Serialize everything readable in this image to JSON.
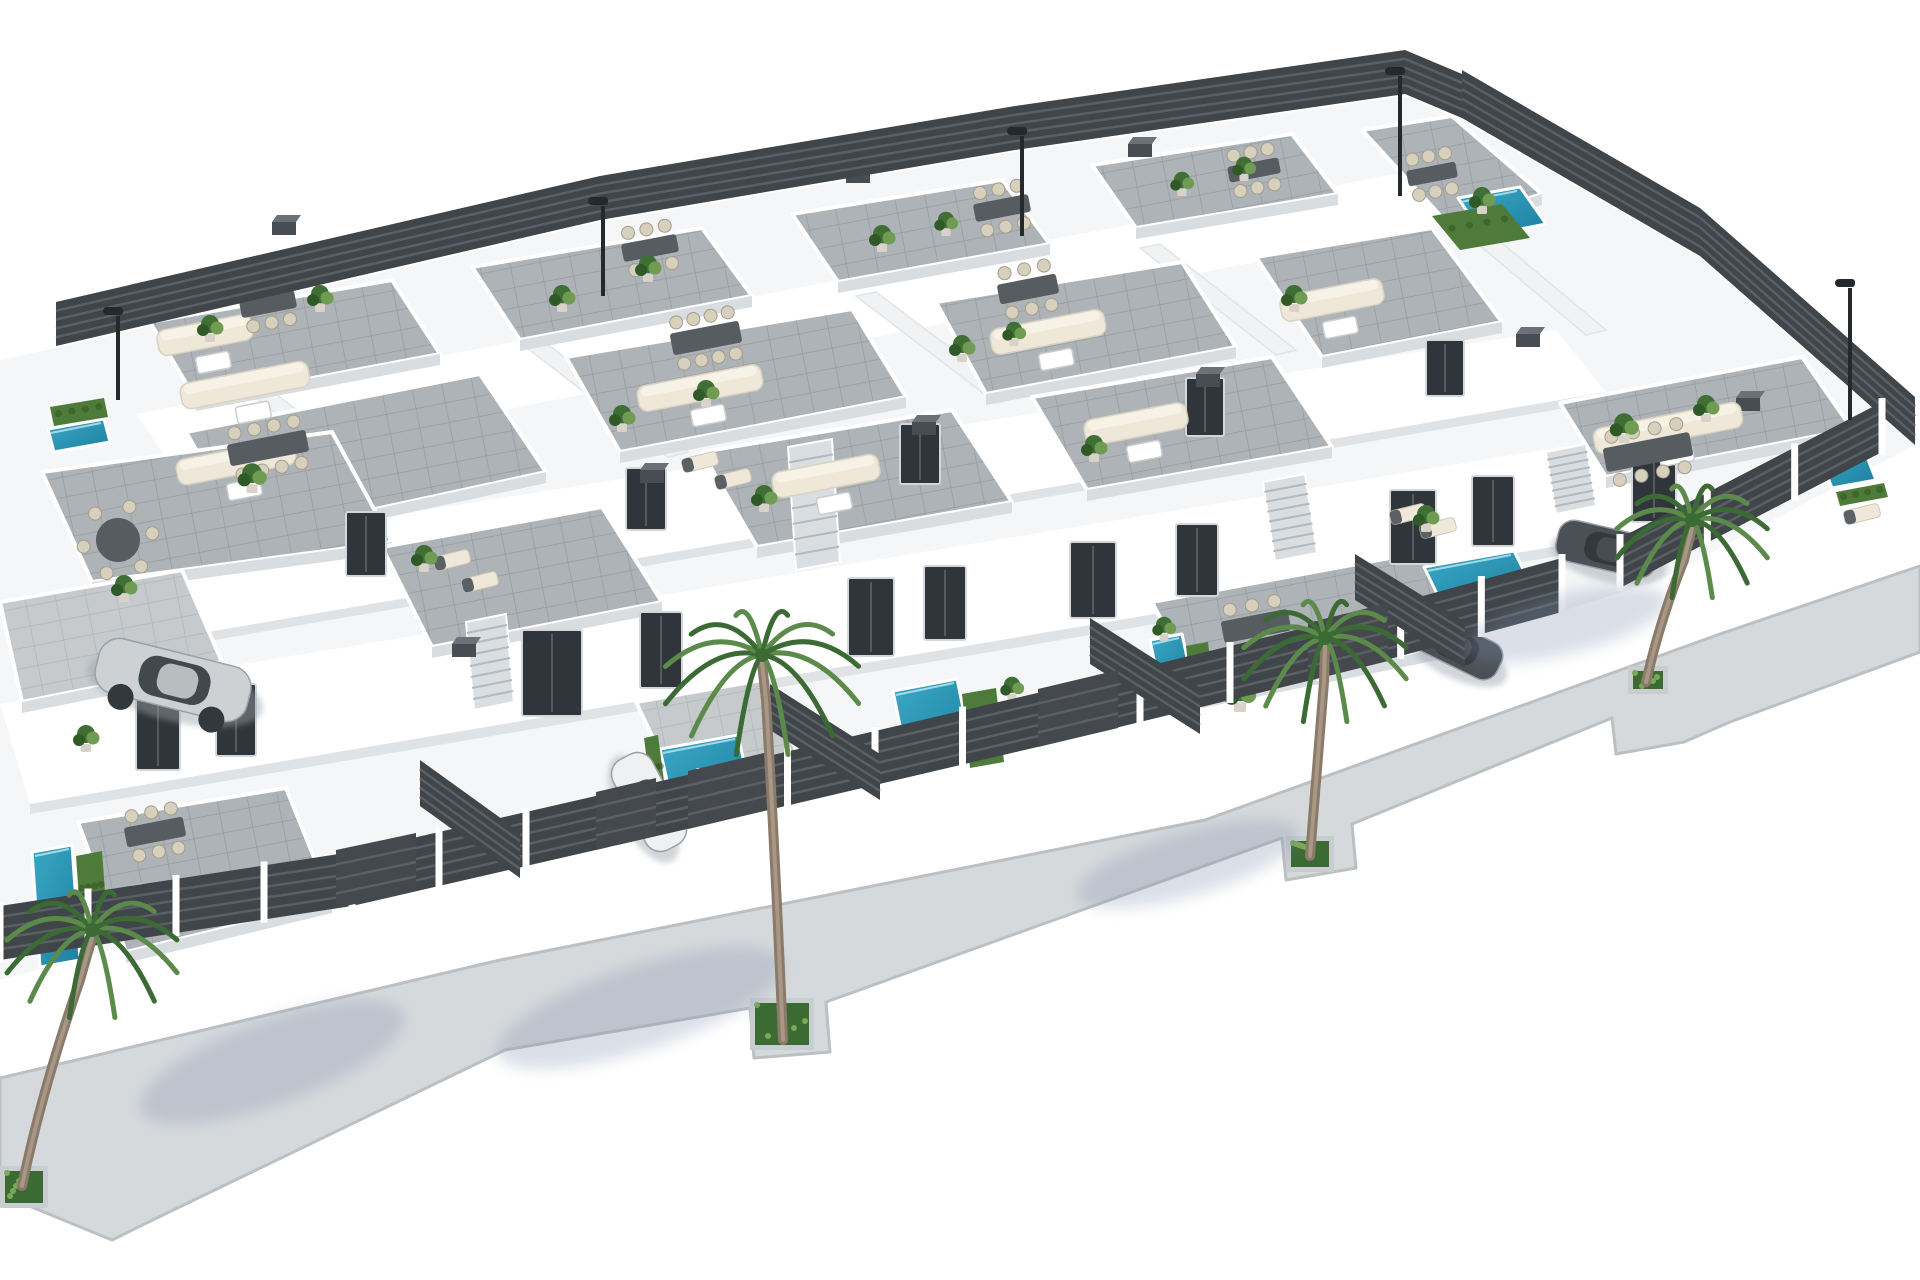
{
  "meta": {
    "description": "3D aerial architectural rendering of a modern white villa residential complex with grey-tiled rooftop terraces, outdoor lounge and dining furniture, private turquoise pools, dark slatted perimeter fences, palm trees on a surrounding sidewalk, parked cars and street lamps on a white background."
  },
  "scene": {
    "background": "#ffffff",
    "colors": {
      "wall": "#ffffff",
      "wall_shade": "#e8ebee",
      "terrace_tile": "#adb3b6",
      "terrace_tile_light": "#c6cacc",
      "terrace_grout": "#969ca0",
      "fence_dark": "#3f4549",
      "fence_slat": "#5a5f64",
      "pool_light": "#3aa8c6",
      "pool_deep": "#1d7fa0",
      "hedge_green": "#4e7b3a",
      "plant_green": "#3f6f35",
      "plant_light": "#6f9c52",
      "palm_green": "#5b8a4a",
      "palm_dark": "#3c6a35",
      "trunk_brown": "#8a7a6a",
      "sidewalk": "#d6d9db",
      "sidewalk_edge": "#bcc0c3",
      "shadow_blue": "#7e90ad",
      "car_silver": "#cdd1d4",
      "car_white": "#eef0f1",
      "car_dark": "#4a5056",
      "glass_dark": "#2f353a",
      "cream": "#efe8d8",
      "furniture_gray": "#565c60",
      "lamp_black": "#26292c"
    },
    "counts": {
      "villas_visible": 15,
      "rooftop_terraces": 18,
      "pools": 8,
      "palm_trees": 4,
      "street_lamps": 5,
      "cars": 4
    }
  },
  "ground": {
    "lot": [
      56,
      348,
      600,
      222,
      1015,
      152,
      1405,
      96,
      1462,
      120,
      1700,
      258,
      1915,
      445,
      1660,
      580,
      1560,
      612,
      1320,
      678,
      1050,
      742,
      700,
      814,
      352,
      884,
      0,
      980,
      0,
      360
    ],
    "sidewalk": [
      0,
      1078,
      500,
      960,
      1205,
      820,
      1720,
      634,
      1920,
      566,
      1920,
      652,
      1730,
      722,
      1684,
      742,
      1616,
      754,
      1612,
      718,
      1352,
      824,
      1356,
      868,
      1286,
      880,
      1282,
      838,
      826,
      1002,
      830,
      1052,
      754,
      1058,
      750,
      1008,
      505,
      1050,
      165,
      1214,
      112,
      1240,
      0,
      1194
    ]
  },
  "objects": {
    "wallbands": [
      [
        136,
        414,
        1458,
        162,
        1500,
        214,
        178,
        474
      ],
      [
        100,
        562,
        1556,
        330,
        1606,
        392,
        150,
        642
      ],
      [
        0,
        704,
        1652,
        432,
        1688,
        524,
        30,
        804
      ]
    ],
    "wallshades": [
      [
        30,
        804,
        1688,
        524,
        1688,
        534,
        30,
        814
      ],
      [
        150,
        642,
        1606,
        392,
        1606,
        401,
        150,
        651
      ]
    ],
    "separators": [
      [
        248,
        392,
        268,
        388,
        418,
        502,
        398,
        507
      ],
      [
        522,
        344,
        542,
        340,
        688,
        452,
        668,
        457
      ],
      [
        856,
        296,
        876,
        292,
        1016,
        398,
        996,
        403
      ],
      [
        1140,
        248,
        1160,
        244,
        1296,
        350,
        1276,
        355
      ],
      [
        1452,
        222,
        1472,
        218,
        1606,
        330,
        1586,
        335
      ]
    ],
    "terraces": [
      {
        "p": [
          150,
          322,
          392,
          280,
          440,
          354,
          196,
          400
        ]
      },
      {
        "p": [
          472,
          267,
          702,
          228,
          752,
          296,
          520,
          340
        ]
      },
      {
        "p": [
          792,
          214,
          1002,
          180,
          1050,
          244,
          838,
          282
        ]
      },
      {
        "p": [
          1092,
          165,
          1292,
          134,
          1338,
          194,
          1136,
          228
        ]
      },
      {
        "p": [
          1362,
          130,
          1452,
          116,
          1542,
          194,
          1448,
          224
        ]
      },
      {
        "p": [
          186,
          432,
          480,
          374,
          546,
          472,
          246,
          537
        ]
      },
      {
        "p": [
          566,
          357,
          852,
          309,
          906,
          397,
          620,
          452
        ]
      },
      {
        "p": [
          936,
          302,
          1182,
          262,
          1236,
          347,
          986,
          394
        ]
      },
      {
        "p": [
          1256,
          257,
          1432,
          228,
          1502,
          322,
          1322,
          357
        ]
      },
      {
        "p": [
          1560,
          403,
          1802,
          357,
          1852,
          429,
          1606,
          477
        ]
      },
      {
        "p": [
          42,
          472,
          332,
          432,
          392,
          542,
          92,
          582
        ]
      },
      {
        "p": [
          382,
          547,
          602,
          507,
          662,
          602,
          432,
          647
        ]
      },
      {
        "p": [
          702,
          452,
          952,
          410,
          1012,
          502,
          757,
          547
        ]
      },
      {
        "p": [
          1032,
          397,
          1272,
          357,
          1332,
          447,
          1087,
          490
        ]
      },
      {
        "p": [
          0,
          602,
          182,
          570,
          222,
          662,
          22,
          702
        ],
        "t": 2
      },
      {
        "p": [
          1152,
          602,
          1422,
          552,
          1472,
          642,
          1202,
          697
        ]
      },
      {
        "p": [
          636,
          702,
          762,
          680,
          802,
          762,
          676,
          787
        ],
        "t": 2
      },
      {
        "p": [
          78,
          822,
          286,
          788,
          332,
          902,
          126,
          952
        ]
      }
    ],
    "stairs": [
      [
        788,
        447,
        832,
        439,
        840,
        562,
        796,
        570
      ],
      [
        1263,
        482,
        1305,
        474,
        1317,
        553,
        1275,
        561
      ],
      [
        466,
        622,
        506,
        614,
        514,
        702,
        474,
        710
      ],
      [
        1546,
        452,
        1586,
        444,
        1596,
        506,
        1556,
        514
      ]
    ],
    "pools": [
      [
        1458,
        198,
        1520,
        187,
        1546,
        224,
        1484,
        236
      ],
      [
        1818,
        452,
        1862,
        444,
        1876,
        480,
        1832,
        488
      ],
      [
        1424,
        567,
        1514,
        551,
        1534,
        591,
        1444,
        608
      ],
      [
        1150,
        640,
        1182,
        634,
        1192,
        681,
        1160,
        688
      ],
      [
        893,
        691,
        957,
        679,
        974,
        762,
        910,
        775
      ],
      [
        660,
        749,
        738,
        735,
        754,
        807,
        676,
        821
      ],
      [
        32,
        852,
        72,
        845,
        80,
        960,
        40,
        967
      ],
      [
        48,
        429,
        104,
        419,
        110,
        442,
        54,
        452
      ]
    ],
    "hedges": [
      [
        76,
        856,
        102,
        851,
        108,
        932,
        82,
        938
      ],
      [
        644,
        738,
        658,
        735,
        668,
        812,
        654,
        815
      ],
      [
        1426,
        612,
        1514,
        596,
        1519,
        611,
        1431,
        627
      ],
      [
        1836,
        492,
        1884,
        483,
        1888,
        497,
        1840,
        506
      ],
      [
        962,
        694,
        996,
        688,
        1004,
        762,
        970,
        768
      ],
      [
        50,
        407,
        104,
        398,
        108,
        417,
        54,
        426
      ],
      [
        1186,
        646,
        1208,
        642,
        1214,
        694,
        1192,
        698
      ],
      [
        1432,
        216,
        1502,
        204,
        1530,
        238,
        1460,
        250
      ]
    ],
    "doors": [
      [
        136,
        696,
        44,
        74
      ],
      [
        216,
        684,
        40,
        72
      ],
      [
        522,
        630,
        60,
        86
      ],
      [
        640,
        612,
        42,
        76
      ],
      [
        848,
        578,
        46,
        78
      ],
      [
        924,
        566,
        42,
        74
      ],
      [
        1070,
        542,
        46,
        76
      ],
      [
        1176,
        524,
        42,
        72
      ],
      [
        1390,
        490,
        46,
        74
      ],
      [
        1472,
        476,
        42,
        70
      ],
      [
        1632,
        450,
        44,
        72
      ],
      [
        346,
        512,
        40,
        64
      ],
      [
        626,
        468,
        40,
        62
      ],
      [
        900,
        424,
        40,
        60
      ],
      [
        1186,
        378,
        38,
        58
      ],
      [
        1426,
        340,
        38,
        56
      ]
    ],
    "acs": [
      [
        272,
        222
      ],
      [
        560,
        202
      ],
      [
        846,
        170
      ],
      [
        1128,
        144
      ],
      [
        640,
        470
      ],
      [
        912,
        422
      ],
      [
        1196,
        374
      ],
      [
        452,
        644
      ],
      [
        1516,
        334
      ],
      [
        1736,
        398
      ]
    ],
    "sofas": [
      [
        205,
        335,
        96
      ],
      [
        245,
        385,
        130
      ],
      [
        700,
        388,
        126
      ],
      [
        1048,
        332,
        116
      ],
      [
        1332,
        300,
        104
      ],
      [
        1668,
        428,
        150
      ],
      [
        826,
        476,
        108
      ],
      [
        1136,
        424,
        104
      ],
      [
        236,
        462,
        120
      ]
    ],
    "dinings": [
      {
        "x": 706,
        "y": 338,
        "w": 70,
        "h": 22,
        "n": 8
      },
      {
        "x": 1028,
        "y": 289,
        "w": 60,
        "h": 20,
        "n": 6
      },
      {
        "x": 1648,
        "y": 452,
        "w": 88,
        "h": 24,
        "n": 8
      },
      {
        "x": 1256,
        "y": 626,
        "w": 68,
        "h": 22,
        "n": 6
      },
      {
        "x": 268,
        "y": 448,
        "w": 80,
        "h": 22,
        "n": 8
      },
      {
        "x": 268,
        "y": 304,
        "w": 56,
        "h": 18,
        "n": 6
      },
      {
        "x": 650,
        "y": 248,
        "w": 56,
        "h": 18,
        "n": 6
      },
      {
        "x": 1002,
        "y": 208,
        "w": 56,
        "h": 18,
        "n": 6
      },
      {
        "x": 1254,
        "y": 170,
        "w": 52,
        "h": 16,
        "n": 6
      },
      {
        "x": 1432,
        "y": 174,
        "w": 50,
        "h": 16,
        "n": 6
      },
      {
        "x": 155,
        "y": 832,
        "w": 60,
        "h": 20,
        "n": 6
      },
      {
        "x": 118,
        "y": 540,
        "r": 22,
        "n": 6,
        "round": 1
      }
    ],
    "loungers": [
      [
        452,
        560
      ],
      [
        480,
        582
      ],
      [
        700,
        462
      ],
      [
        733,
        479
      ],
      [
        1408,
        514
      ],
      [
        1438,
        528
      ],
      [
        128,
        894
      ],
      [
        162,
        914
      ],
      [
        1862,
        514
      ]
    ],
    "plants": [
      [
        210,
        332,
        1
      ],
      [
        320,
        302,
        1
      ],
      [
        562,
        302,
        1
      ],
      [
        648,
        272,
        1
      ],
      [
        882,
        242,
        1
      ],
      [
        946,
        227,
        0.9
      ],
      [
        1182,
        187,
        0.9
      ],
      [
        1244,
        172,
        0.9
      ],
      [
        1482,
        204,
        1
      ],
      [
        252,
        482,
        1.1
      ],
      [
        622,
        422,
        1
      ],
      [
        706,
        397,
        1
      ],
      [
        962,
        352,
        1
      ],
      [
        1014,
        337,
        0.9
      ],
      [
        1294,
        302,
        1
      ],
      [
        1624,
        432,
        1.1
      ],
      [
        1706,
        412,
        1
      ],
      [
        124,
        592,
        1
      ],
      [
        424,
        562,
        1
      ],
      [
        764,
        502,
        1
      ],
      [
        1094,
        452,
        1
      ],
      [
        1426,
        522,
        1
      ],
      [
        234,
        692,
        1
      ],
      [
        1164,
        632,
        0.9
      ],
      [
        1012,
        692,
        0.9
      ],
      [
        1352,
        642,
        0.9
      ],
      [
        86,
        742,
        1
      ],
      [
        1240,
        700,
        1.2
      ]
    ],
    "fences": [
      [
        56,
        346,
        600,
        220,
        44,
        0
      ],
      [
        600,
        220,
        1015,
        150,
        44,
        0
      ],
      [
        1015,
        150,
        1405,
        94,
        44,
        0
      ],
      [
        1405,
        94,
        1462,
        118,
        44,
        0
      ],
      [
        1462,
        118,
        1700,
        256,
        48,
        0
      ],
      [
        1700,
        256,
        1915,
        445,
        48,
        0
      ],
      [
        0,
        960,
        352,
        906,
        54,
        1
      ],
      [
        352,
        906,
        700,
        826,
        54,
        1
      ],
      [
        700,
        826,
        1050,
        744,
        54,
        1
      ],
      [
        1050,
        744,
        1320,
        678,
        54,
        1
      ],
      [
        1320,
        678,
        1562,
        612,
        54,
        1
      ],
      [
        1620,
        588,
        1882,
        452,
        50,
        1
      ],
      [
        420,
        806,
        520,
        878,
        46,
        0
      ],
      [
        770,
        730,
        880,
        800,
        46,
        0
      ],
      [
        1090,
        664,
        1200,
        734,
        46,
        0
      ],
      [
        1355,
        600,
        1465,
        668,
        46,
        0
      ]
    ],
    "gates": [
      [
        336,
        908,
        416,
        891
      ],
      [
        688,
        829,
        768,
        810
      ],
      [
        1038,
        747,
        1118,
        728
      ],
      [
        1308,
        681,
        1388,
        661
      ],
      [
        596,
        850,
        656,
        836
      ]
    ],
    "cars": [
      {
        "x": 95,
        "y": 652,
        "rot": 14,
        "len": 156,
        "wid": 56,
        "body": "silver",
        "wheels": 1
      },
      {
        "x": 598,
        "y": 780,
        "rot": 62,
        "len": 102,
        "wid": 44,
        "body": "white",
        "wheels": 0
      },
      {
        "x": 1408,
        "y": 626,
        "rot": 26,
        "len": 96,
        "wid": 40,
        "body": "dark",
        "wheels": 0
      },
      {
        "x": 1556,
        "y": 528,
        "rot": 13,
        "len": 102,
        "wid": 42,
        "body": "dark",
        "wheels": 0
      }
    ],
    "planters": [
      [
        750,
        998,
        64,
        52
      ],
      [
        1286,
        836,
        48,
        36
      ],
      [
        1628,
        666,
        40,
        28
      ],
      [
        0,
        1166,
        48,
        42
      ]
    ],
    "palms": [
      {
        "cx": 762,
        "cy": 655,
        "r": 100,
        "trunk": [
          [
            783,
            1040
          ],
          [
            775,
            850
          ],
          [
            766,
            700
          ]
        ],
        "shadow": [
          640,
          1008,
          150,
          42,
          -18
        ]
      },
      {
        "cx": 1325,
        "cy": 638,
        "r": 84,
        "trunk": [
          [
            1310,
            856
          ],
          [
            1318,
            760
          ],
          [
            1324,
            682
          ]
        ],
        "shadow": [
          1188,
          864,
          115,
          32,
          -16
        ]
      },
      {
        "cx": 1692,
        "cy": 520,
        "r": 78,
        "trunk": [
          [
            1646,
            682
          ],
          [
            1660,
            620
          ],
          [
            1684,
            560
          ]
        ],
        "shadow": [
          1566,
          624,
          105,
          30,
          -14
        ]
      },
      {
        "cx": 92,
        "cy": 930,
        "r": 88,
        "trunk": [
          [
            22,
            1186
          ],
          [
            42,
            1090
          ],
          [
            80,
            980
          ]
        ],
        "shadow": [
          272,
          1062,
          140,
          42,
          -20
        ]
      }
    ],
    "lamps": [
      [
        118,
        316,
        400
      ],
      [
        603,
        206,
        296
      ],
      [
        1022,
        136,
        236
      ],
      [
        1400,
        76,
        196
      ],
      [
        1850,
        288,
        420
      ]
    ]
  }
}
